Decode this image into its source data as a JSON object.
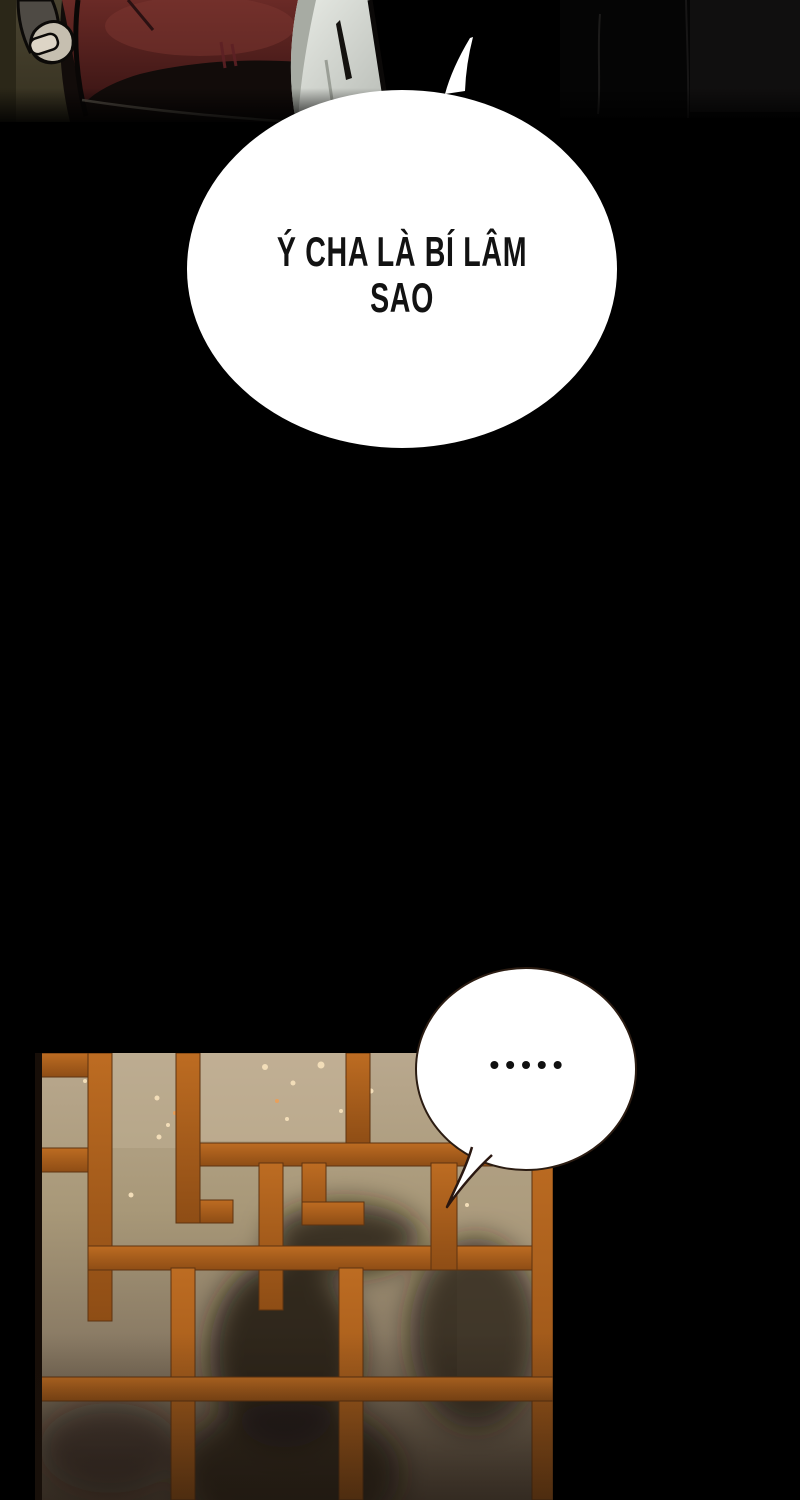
{
  "comic": {
    "bubble_main": {
      "line1": "Ý CHA LÀ BÍ LÂM",
      "line2": "SAO",
      "fill": "#ffffff",
      "text_color": "#121212"
    },
    "bubble_ellipsis": {
      "dots": "•••••",
      "dot_count": 5,
      "fill": "#ffffff",
      "outline_color": "#2b1c12"
    },
    "colors": {
      "page_background": "#000000",
      "panel_background_olive": "#433d2b",
      "robe_crimson": "#5d2422",
      "robe_white": "#dfe2dc",
      "lattice_wood_orange": "#a95c1e",
      "lattice_paper_tan": "#b9a88e",
      "shadow_silhouette": "#1f1813"
    }
  }
}
